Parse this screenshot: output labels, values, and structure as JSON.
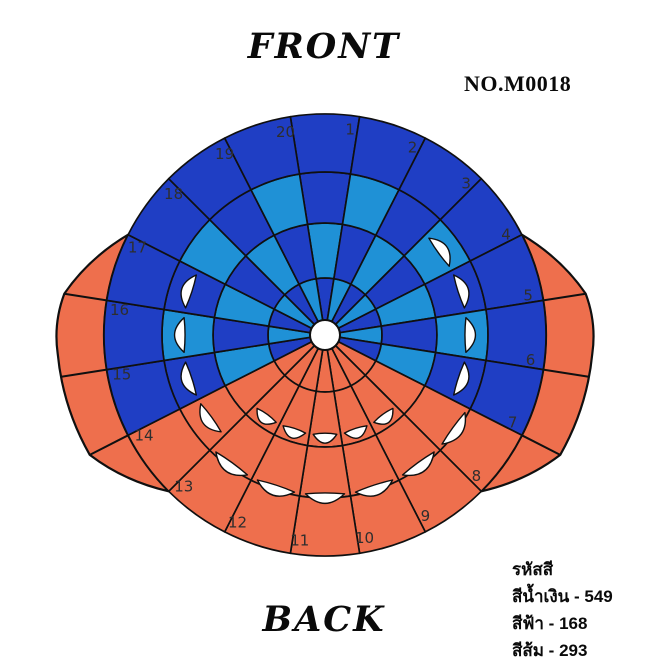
{
  "header": {
    "front_label": "FRONT",
    "part_no": "NO.M0018"
  },
  "footer": {
    "back_label": "BACK"
  },
  "legend": {
    "heading": "รหัสสี",
    "items": [
      {
        "name": "สีน้ำเงิน",
        "code": "549",
        "color_key": "navy"
      },
      {
        "name": "สีฟ้า",
        "code": "168",
        "color_key": "sky"
      },
      {
        "name": "สีส้ม",
        "code": "293",
        "color_key": "orange"
      }
    ]
  },
  "figure": {
    "center": {
      "x": 325,
      "y": 335
    },
    "outer_radius": 221,
    "hole_radius": 15,
    "sector_count": 20,
    "sector_angle": 18,
    "sector_labels": [
      "1",
      "2",
      "3",
      "4",
      "5",
      "6",
      "7",
      "8",
      "9",
      "10",
      "11",
      "12",
      "13",
      "14",
      "15",
      "16",
      "17",
      "18",
      "19",
      "20"
    ],
    "label_radius": 207,
    "label_angle_offset": 7,
    "label_color": "#2e2e2e",
    "label_font_size": 15,
    "palette": {
      "navy": "#1f3ec4",
      "sky": "#1f91d6",
      "orange": "#ee6f4d",
      "outline": "#101010",
      "hole": "#ffffff",
      "dart": "#ffffff"
    },
    "rings": [
      {
        "name": "ring-1-inner-wedges",
        "r0": 15,
        "r1": 57,
        "colors": [
          "navy",
          "sky",
          "navy",
          "sky",
          "navy",
          "sky",
          "navy",
          "orange",
          "orange",
          "orange",
          "orange",
          "orange",
          "orange",
          "orange",
          "navy",
          "sky",
          "navy",
          "sky",
          "navy",
          "sky"
        ]
      },
      {
        "name": "ring-2",
        "r0": 57,
        "r1": 112,
        "colors": [
          "sky",
          "navy",
          "sky",
          "navy",
          "sky",
          "navy",
          "sky",
          "orange",
          "orange",
          "orange",
          "orange",
          "orange",
          "orange",
          "orange",
          "sky",
          "navy",
          "sky",
          "navy",
          "sky",
          "navy"
        ]
      },
      {
        "name": "ring-3",
        "r0": 112,
        "r1": 163,
        "colors": [
          "navy",
          "sky",
          "navy",
          "sky",
          "navy",
          "sky",
          "navy",
          "orange",
          "orange",
          "orange",
          "orange",
          "orange",
          "orange",
          "orange",
          "navy",
          "sky",
          "navy",
          "sky",
          "navy",
          "sky"
        ]
      },
      {
        "name": "ring-4-outer",
        "r0": 163,
        "r1": 221,
        "colors": [
          "navy",
          "navy",
          "navy",
          "navy",
          "navy",
          "navy",
          "navy",
          "orange",
          "orange",
          "orange",
          "orange",
          "orange",
          "orange",
          "orange",
          "navy",
          "navy",
          "navy",
          "navy",
          "navy",
          "navy"
        ]
      }
    ],
    "darts": [
      {
        "name": "outer-bottom-darts",
        "base_radius": 160,
        "bulge": 18,
        "half_width_deg": 7,
        "sectors": [
          8,
          9,
          10,
          11,
          12,
          13
        ]
      },
      {
        "name": "side-darts",
        "base_radius": 142,
        "bulge": 18,
        "half_width_deg": 7,
        "sectors": [
          4,
          5,
          6,
          7,
          14,
          15,
          16,
          17
        ]
      },
      {
        "name": "inner-bottom-darts",
        "base_radius": 100,
        "bulge": 17,
        "half_width_deg": 6.8,
        "sectors": [
          9,
          10,
          11,
          12,
          13
        ]
      }
    ],
    "wings": [
      {
        "name": "ear-flap-left",
        "edge": [
          [
            225,
            221
          ],
          [
            243,
            264
          ],
          [
            266,
            268
          ],
          [
            279,
            264
          ],
          [
            297,
            221
          ]
        ],
        "ribs": [
          [
            243,
            264
          ],
          [
            261,
            267
          ],
          [
            279,
            264
          ]
        ]
      },
      {
        "name": "ear-flap-right",
        "edge": [
          [
            63,
            221
          ],
          [
            81,
            264
          ],
          [
            94,
            268
          ],
          [
            117,
            264
          ],
          [
            135,
            221
          ]
        ],
        "ribs": [
          [
            81,
            264
          ],
          [
            99,
            267
          ],
          [
            117,
            264
          ]
        ]
      }
    ]
  }
}
